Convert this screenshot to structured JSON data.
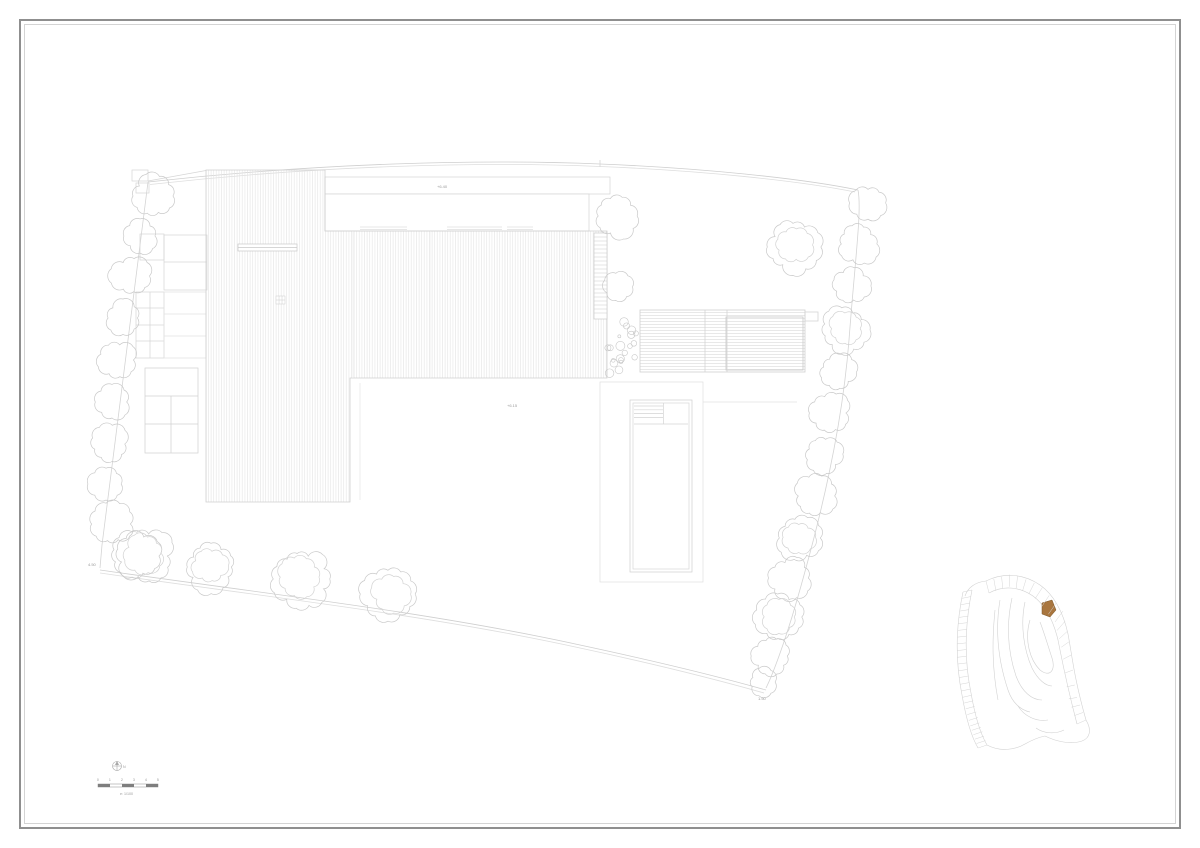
{
  "annotations": {
    "roof_level": "+6.40",
    "terrace_level": "+6.15",
    "corner_left": "4.50",
    "corner_right": "1.50"
  },
  "scale": {
    "ticks": [
      "0",
      "1",
      "2",
      "3",
      "4",
      "5"
    ],
    "caption": "e: 1/100",
    "north_label": "N"
  },
  "colors": {
    "frame": "#8f8f8f",
    "line_light": "#e2e2e2",
    "line_mid": "#cccccc",
    "tree_line": "#c9c9c9",
    "highlight_parcel": "#a9763f"
  }
}
